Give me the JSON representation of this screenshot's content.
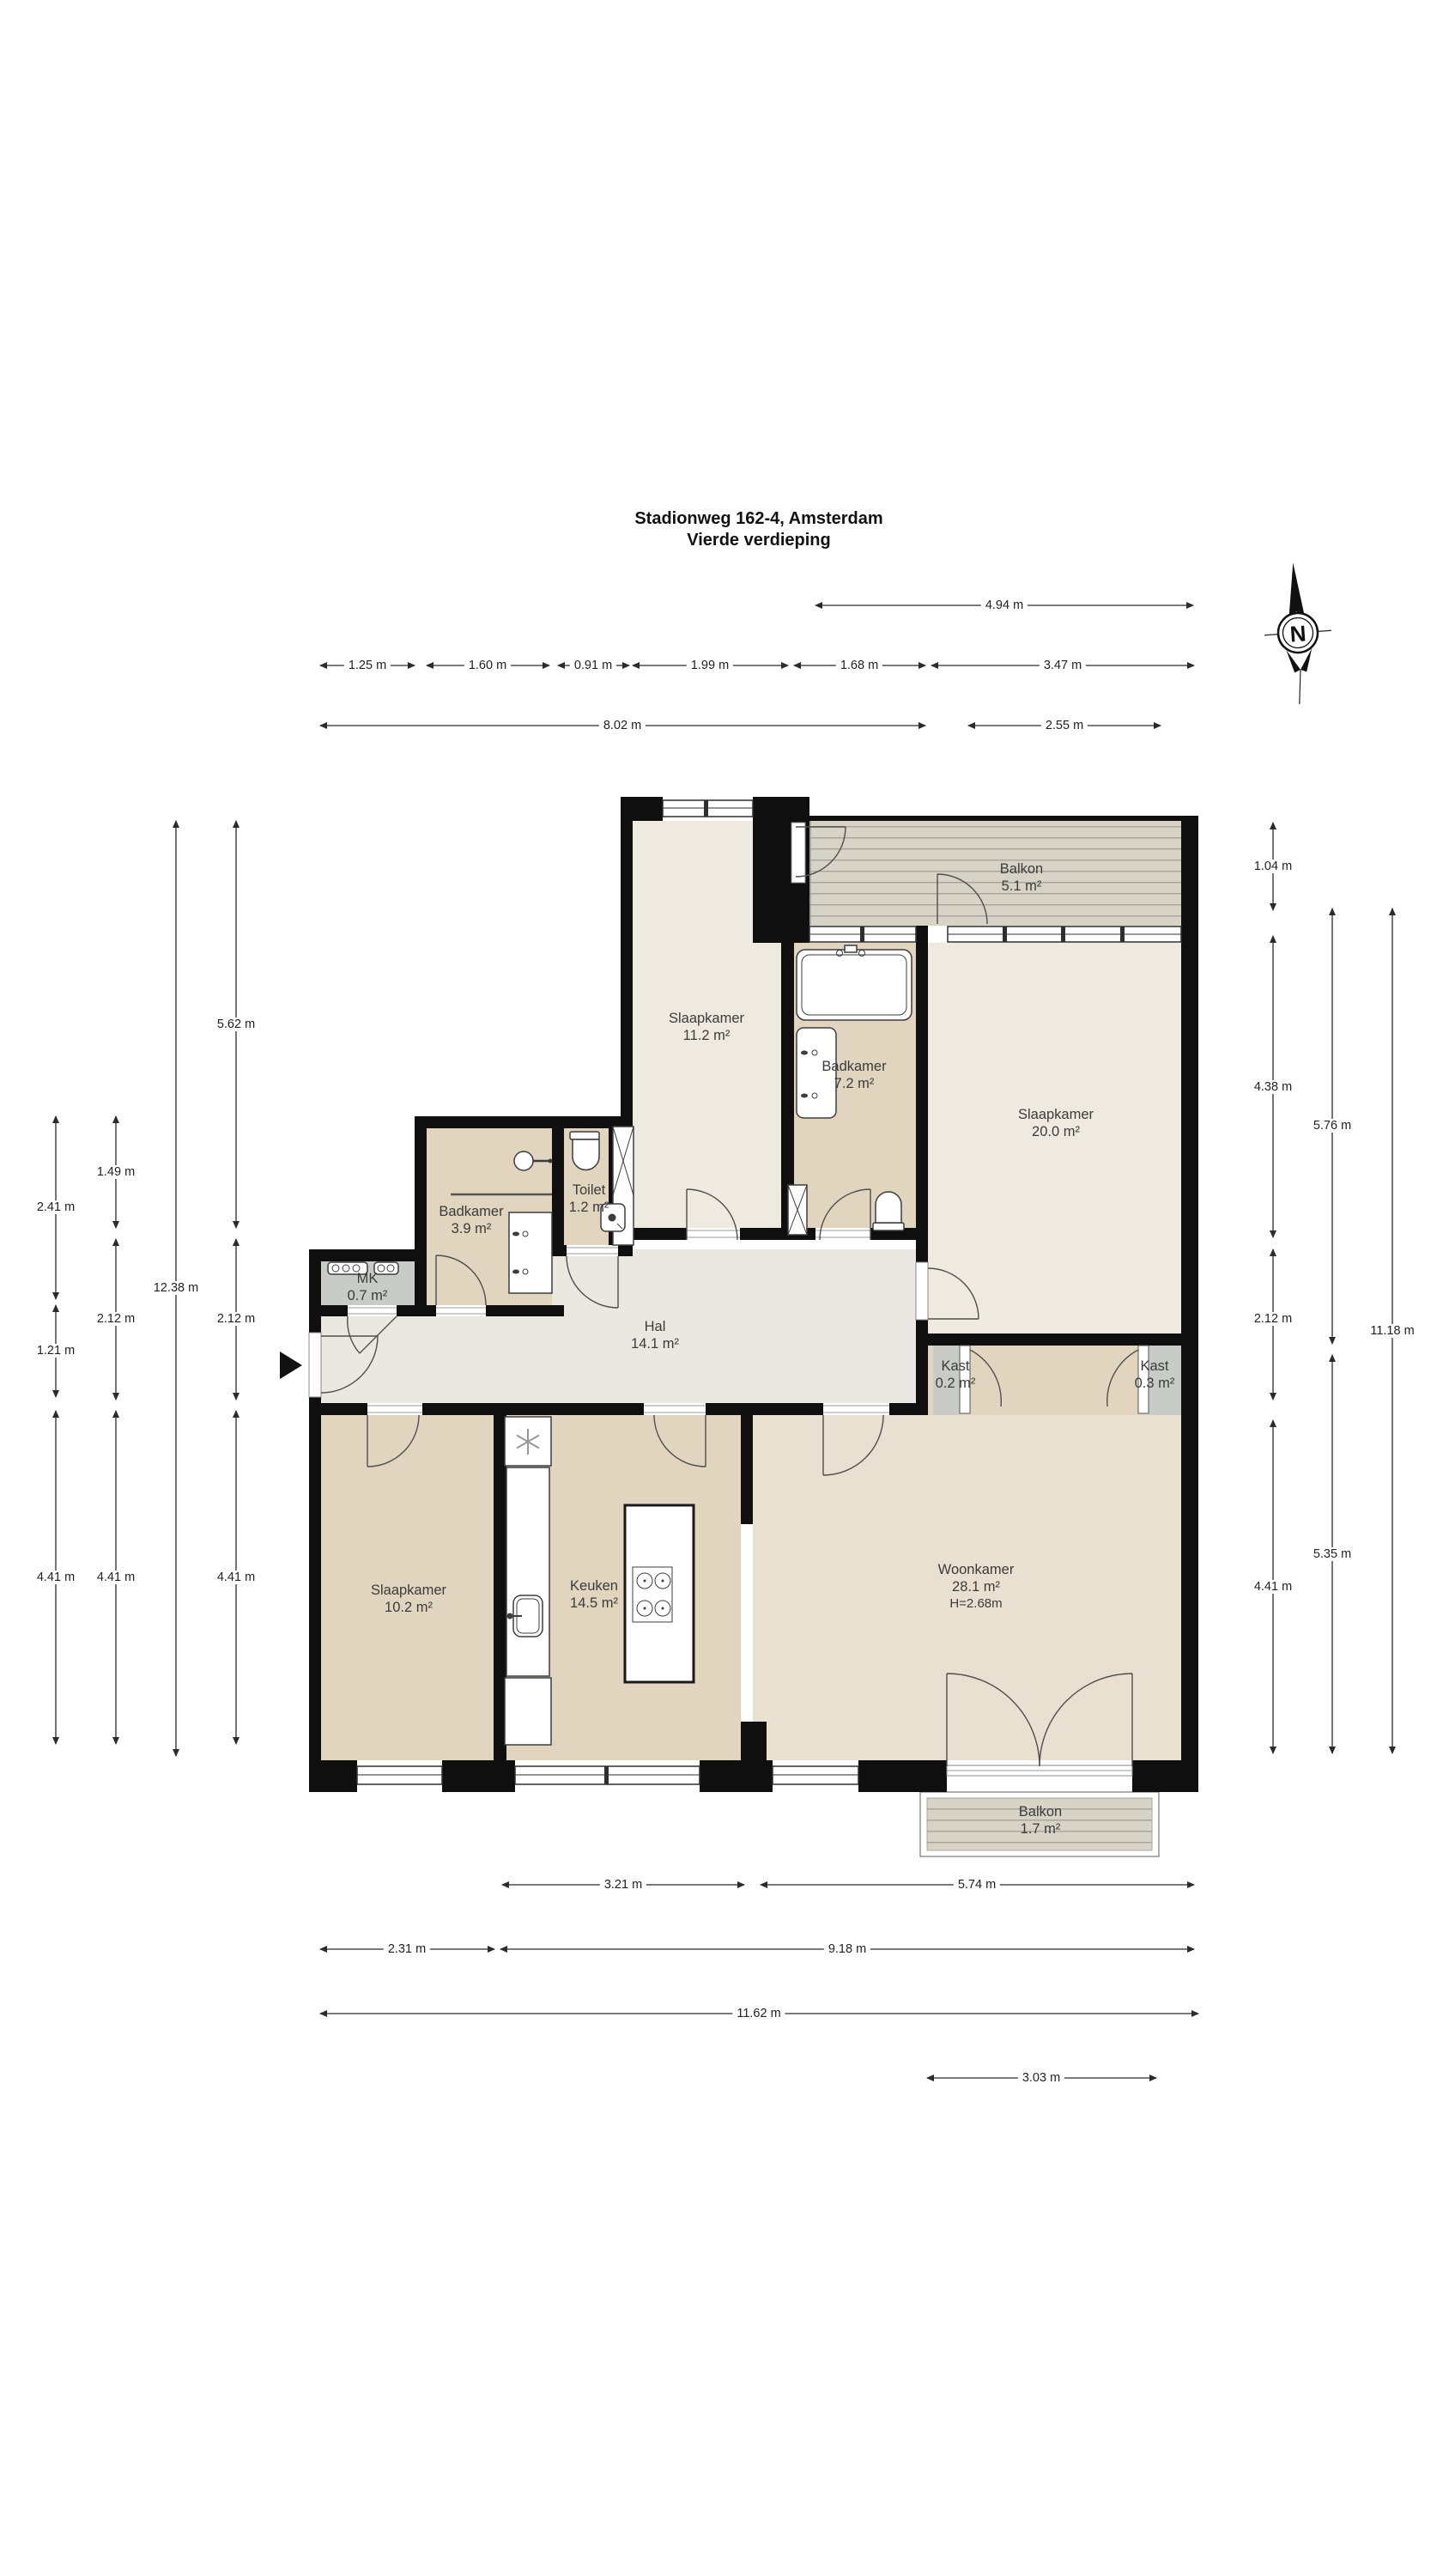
{
  "title": {
    "line1": "Stadionweg 162-4, Amsterdam",
    "line2": "Vierde verdieping"
  },
  "compass": {
    "label": "N"
  },
  "rooms": [
    {
      "name": "Balkon",
      "area": "5.1 m²"
    },
    {
      "name": "Slaapkamer",
      "area": "11.2 m²"
    },
    {
      "name": "Badkamer",
      "area": "7.2 m²"
    },
    {
      "name": "Slaapkamer",
      "area": "20.0 m²"
    },
    {
      "name": "Toilet",
      "area": "1.2 m²"
    },
    {
      "name": "Badkamer",
      "area": "3.9 m²"
    },
    {
      "name": "MK",
      "area": "0.7 m²"
    },
    {
      "name": "Hal",
      "area": "14.1 m²"
    },
    {
      "name": "Kast",
      "area": "0.2 m²"
    },
    {
      "name": "Kast",
      "area": "0.3 m²"
    },
    {
      "name": "Slaapkamer",
      "area": "10.2 m²"
    },
    {
      "name": "Keuken",
      "area": "14.5 m²"
    },
    {
      "name": "Woonkamer",
      "area": "28.1 m²",
      "height": "H=2.68m"
    },
    {
      "name": "Balkon",
      "area": "1.7 m²"
    }
  ],
  "dims": [
    "4.94 m",
    "1.25 m",
    "1.60 m",
    "0.91 m",
    "1.99 m",
    "1.68 m",
    "3.47 m",
    "8.02 m",
    "2.55 m",
    "2.41 m",
    "1.21 m",
    "4.41 m",
    "1.49 m",
    "2.12 m",
    "4.41 m",
    "12.38 m",
    "5.62 m",
    "2.12 m",
    "4.41 m",
    "1.04 m",
    "4.38 m",
    "2.12 m",
    "4.41 m",
    "5.76 m",
    "5.35 m",
    "11.18 m",
    "3.21 m",
    "5.74 m",
    "2.31 m",
    "9.18 m",
    "11.62 m",
    "3.03 m"
  ],
  "colors": {
    "wall": "#0f0f0f",
    "room_cream": "#efeadf",
    "room_tan": "#e2d5bf",
    "hall": "#ebe8e2",
    "living": "#e9e0d1",
    "closet": "#c8cbc6",
    "deck": "#d7d4c7",
    "deck_stripe": "#aaa79a"
  }
}
